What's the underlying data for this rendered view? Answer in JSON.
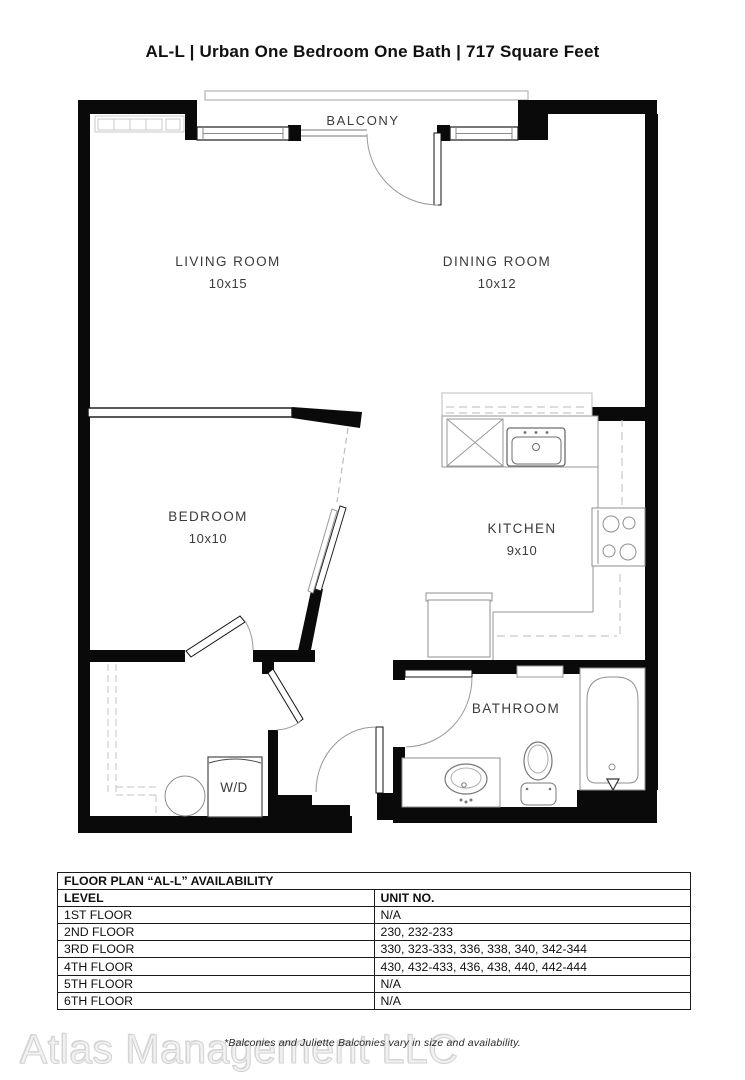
{
  "title": "AL-L | Urban One Bedroom One Bath | 717  Square Feet",
  "floor_plan": {
    "balcony_label": "BALCONY",
    "rooms": {
      "living": {
        "name": "LIVING ROOM",
        "dims": "10x15"
      },
      "dining": {
        "name": "DINING ROOM",
        "dims": "10x12"
      },
      "bedroom": {
        "name": "BEDROOM",
        "dims": "10x10"
      },
      "kitchen": {
        "name": "KITCHEN",
        "dims": "9x10"
      },
      "bathroom": {
        "name": "BATHROOM"
      },
      "laundry": {
        "label": "W/D"
      }
    }
  },
  "availability_table": {
    "title": "FLOOR PLAN “AL-L” AVAILABILITY",
    "columns": [
      "LEVEL",
      "UNIT NO."
    ],
    "rows": [
      {
        "level": "1ST FLOOR",
        "units": "N/A"
      },
      {
        "level": "2ND FLOOR",
        "units": "230, 232-233"
      },
      {
        "level": "3RD FLOOR",
        "units": "330, 323-333, 336, 338, 340, 342-344"
      },
      {
        "level": "4TH FLOOR",
        "units": "430, 432-433, 436, 438, 440, 442-444"
      },
      {
        "level": "5TH FLOOR",
        "units": "N/A"
      },
      {
        "level": "6TH FLOOR",
        "units": "N/A"
      }
    ]
  },
  "footnote": "*Balconies and Juliette Balconies vary in size and availability.",
  "watermark": "Atlas Management LLC",
  "colors": {
    "wall": "#0a0a0a",
    "fixture_line": "#8f8f8f",
    "dashed_line": "#c8c8c8",
    "label_text": "#3b3b3b"
  }
}
